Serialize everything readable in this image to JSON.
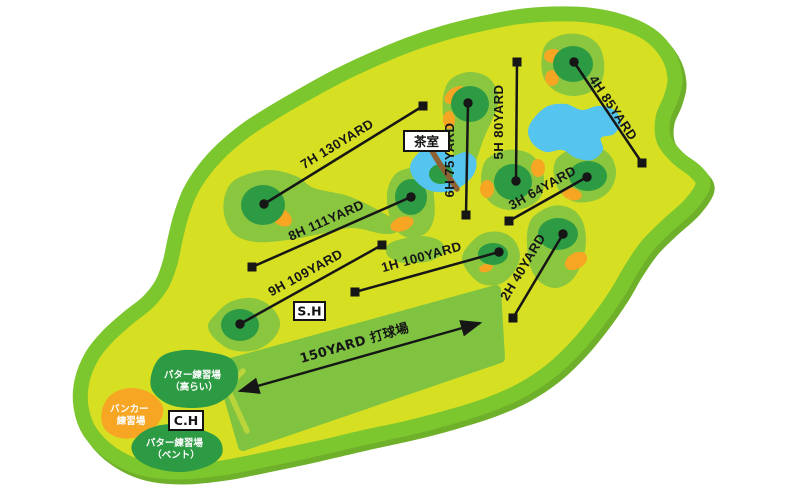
{
  "map": {
    "type": "golf-short-course-layout",
    "colors": {
      "background": "#ffffff",
      "course_base": "#d7df23",
      "course_border": "#7cc62e",
      "border_shadow": "#6fb02a",
      "fairway": "#8bc63f",
      "driving_range_band": "#7fc341",
      "putting_green": "#2d9b44",
      "bunker": "#f6a623",
      "water": "#55c4ee",
      "bridge": "#8e6134",
      "line": "#161616",
      "label_box_bg": "#ffffff",
      "label_text_light": "#ffffff"
    }
  },
  "holes": [
    {
      "name": "1H",
      "distance": "100YARD",
      "label": "1H 100YARD"
    },
    {
      "name": "2H",
      "distance": "40YARD",
      "label": "2H 40YARD"
    },
    {
      "name": "3H",
      "distance": "64YARD",
      "label": "3H 64YARD"
    },
    {
      "name": "4H",
      "distance": "85YARD",
      "label": "4H 85YARD"
    },
    {
      "name": "5H",
      "distance": "80YARD",
      "label": "5H 80YARD"
    },
    {
      "name": "6H",
      "distance": "75YARD",
      "label": "6H 75YARD"
    },
    {
      "name": "7H",
      "distance": "130YARD",
      "label": "7H 130YARD"
    },
    {
      "name": "8H",
      "distance": "111YARD",
      "label": "8H 111YARD"
    },
    {
      "name": "9H",
      "distance": "109YARD",
      "label": "9H 109YARD"
    }
  ],
  "driving_range": {
    "label": "150YARD 打球場"
  },
  "facilities": {
    "tea_house": "茶室",
    "start_house": "S.H",
    "club_house": "C.H",
    "putter_green_korai": {
      "line1": "パター練習場",
      "line2": "（高らい）"
    },
    "bunker_practice": {
      "line1": "バンカー",
      "line2": "練習場"
    },
    "putter_green_bent": {
      "line1": "パター練習場",
      "line2": "（ベント）"
    }
  }
}
